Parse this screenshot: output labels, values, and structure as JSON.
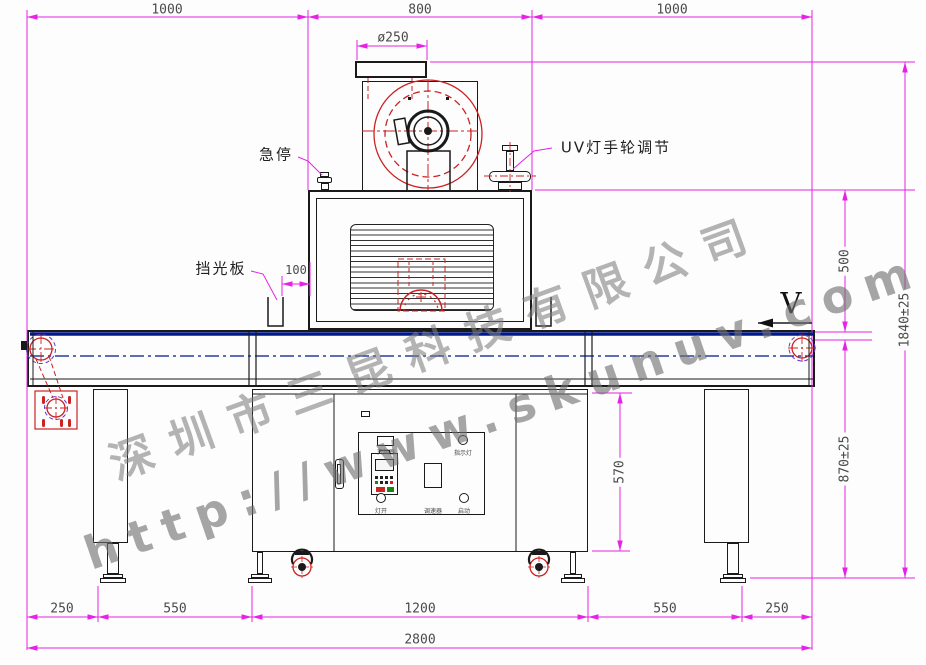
{
  "watermark": {
    "company": "深圳市三昆科技有限公司",
    "url": "http://www.skunuv.com"
  },
  "labels": {
    "emergency_stop": "急停",
    "uv_handwheel": "UV灯手轮调节",
    "light_shield": "挡光板",
    "direction": "V"
  },
  "dimensions": {
    "top": [
      "1000",
      "800",
      "1000"
    ],
    "fan_diameter": "ø250",
    "shield_offset": "100",
    "housing_height": "500",
    "overall_height": "1840±25",
    "belt_height": "870±25",
    "cabinet_height": "570",
    "bottom": [
      "250",
      "550",
      "1200",
      "550",
      "250"
    ],
    "overall_length": "2800"
  },
  "control_panel": {
    "inverter": "变频器",
    "lamp_switch": "灯开",
    "speed_controller": "调速器",
    "indicator_light": "指示灯",
    "start": "启动"
  },
  "colors": {
    "dimension_magenta": "#e622e6",
    "outline_black": "#1a1a1a",
    "detail_red": "#cc2222",
    "belt_navy": "#001a8c",
    "watermark_gray": "#7d7d7d"
  }
}
